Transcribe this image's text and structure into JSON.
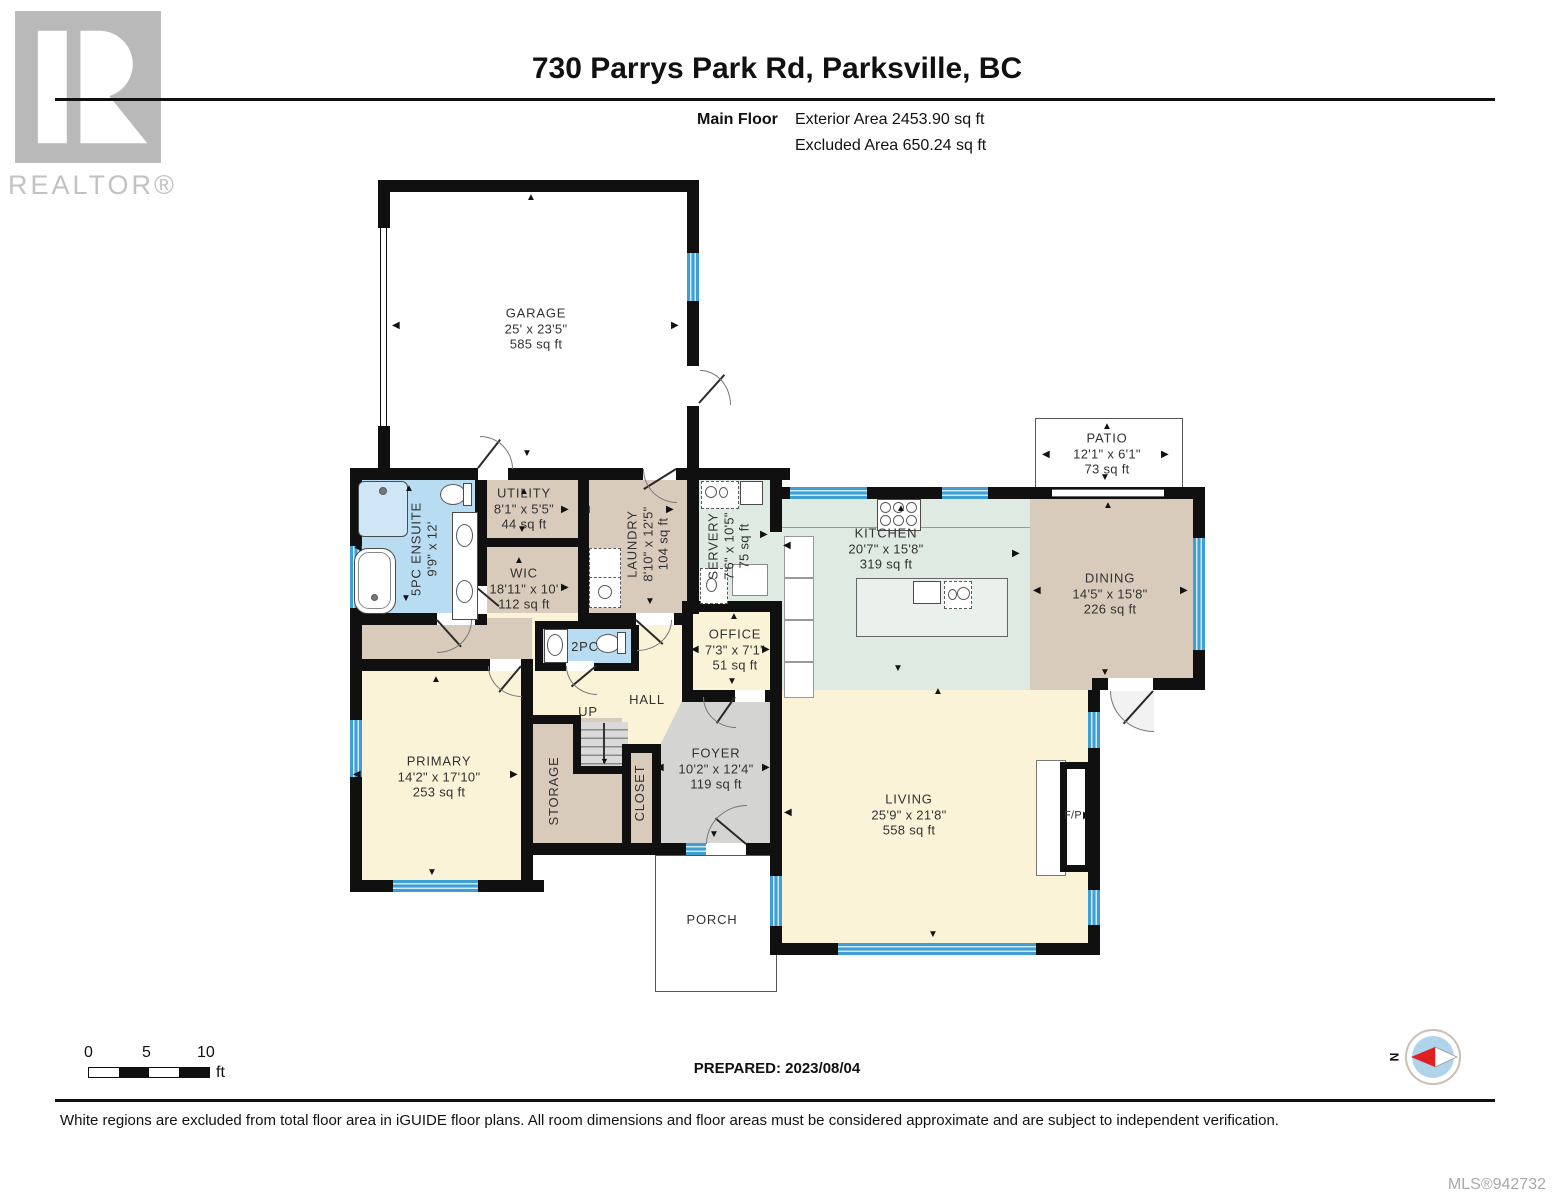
{
  "header": {
    "title": "730 Parrys Park Rd, Parksville, BC",
    "floor_label": "Main Floor",
    "exterior_area": "Exterior Area 2453.90 sq ft",
    "excluded_area": "Excluded Area 650.24 sq ft",
    "logo_text": "REALTOR®"
  },
  "glyphs": {
    "up": "▲",
    "down": "▼",
    "left": "◀",
    "right": "▶"
  },
  "rooms": {
    "garage": {
      "name": "GARAGE",
      "dims": "25' x 23'5\"",
      "area": "585 sq ft"
    },
    "ensuite": {
      "name": "5PC ENSUITE",
      "dims": "9'9\" x 12'"
    },
    "utility": {
      "name": "UTILITY",
      "dims": "8'1\" x 5'5\"",
      "area": "44 sq ft"
    },
    "wic": {
      "name": "WIC",
      "dims": "18'11\" x 10'",
      "area": "112 sq ft"
    },
    "laundry": {
      "name": "LAUNDRY",
      "dims": "8'10\" x 12'5\"",
      "area": "104 sq ft"
    },
    "servery": {
      "name": "SERVERY",
      "dims": "7'6\" x 10'5\"",
      "area": "75 sq ft"
    },
    "kitchen": {
      "name": "KITCHEN",
      "dims": "20'7\" x 15'8\"",
      "area": "319 sq ft"
    },
    "dining": {
      "name": "DINING",
      "dims": "14'5\" x 15'8\"",
      "area": "226 sq ft"
    },
    "patio": {
      "name": "PATIO",
      "dims": "12'1\" x 6'1\"",
      "area": "73 sq ft"
    },
    "office": {
      "name": "OFFICE",
      "dims": "7'3\" x 7'1\"",
      "area": "51 sq ft"
    },
    "two_pc": {
      "name": "2PC"
    },
    "hall": {
      "name": "HALL"
    },
    "up": {
      "name": "UP"
    },
    "storage": {
      "name": "STORAGE"
    },
    "closet": {
      "name": "CLOSET"
    },
    "foyer": {
      "name": "FOYER",
      "dims": "10'2\" x 12'4\"",
      "area": "119 sq ft"
    },
    "primary": {
      "name": "PRIMARY",
      "dims": "14'2\" x 17'10\"",
      "area": "253 sq ft"
    },
    "living": {
      "name": "LIVING",
      "dims": "25'9\" x 21'8\"",
      "area": "558 sq ft"
    },
    "fireplace": {
      "name": "F/P"
    },
    "porch": {
      "name": "PORCH"
    }
  },
  "footer": {
    "scale": {
      "t0": "0",
      "t5": "5",
      "t10": "10",
      "unit": "ft"
    },
    "prepared": "PREPARED: 2023/08/04",
    "compass_north": "N",
    "disclaimer": "White regions are excluded from total floor area in iGUIDE floor plans. All room dimensions and floor areas must be considered approximate and are subject to independent verification.",
    "mls": "MLS®942732"
  },
  "colors": {
    "wall": "#101010",
    "tan": "#d8cbbc",
    "cream": "#fbf3d7",
    "blue_room": "#b8dcf2",
    "green_room": "#dfeae3",
    "gray_room": "#d4d4d3",
    "window": "#3f9fd2"
  }
}
